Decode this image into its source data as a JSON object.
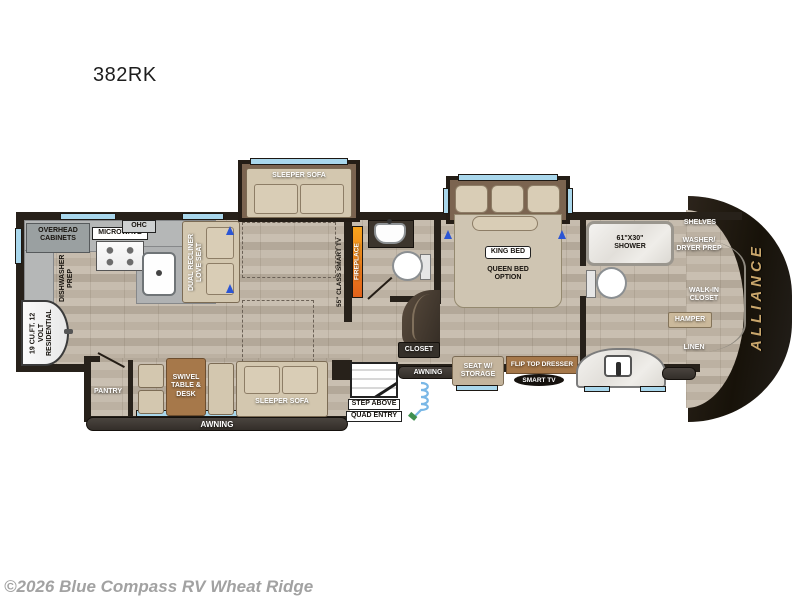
{
  "page": {
    "model": "382RK",
    "copyright": "©2026 Blue Compass RV Wheat Ridge"
  },
  "floorplan": {
    "brand": "ALLIANCE",
    "kitchen": {
      "overhead_cabinets": "OVERHEAD CABINETS",
      "microwave": "MICROWAVE",
      "ohc": "OHC",
      "dishwasher_prep": "DISHWASHER PREP",
      "refrigerator": "19 CU.FT. 12 VOLT RESIDENTIAL",
      "pantry": "PANTRY"
    },
    "living": {
      "sleeper_sofa_top": "SLEEPER SOFA",
      "dual_recliner": "DUAL RECLINER LOVE SEAT",
      "fireplace": "FIREPLACE",
      "class_tv": "55\" CLASS SMART TV",
      "swivel_table_desk": "SWIVEL TABLE & DESK",
      "sleeper_sofa_bottom": "SLEEPER SOFA"
    },
    "entry": {
      "awning_main": "AWNING",
      "awning_entry": "AWNING",
      "step_above": "STEP ABOVE",
      "quad_entry": "QUAD ENTRY",
      "closet": "CLOSET"
    },
    "bedroom": {
      "king_bed": "KING BED",
      "queen_bed_option": "QUEEN BED OPTION",
      "seat_w_storage": "SEAT W/ STORAGE",
      "flip_top_dresser": "FLIP TOP DRESSER",
      "smart_tv": "SMART TV"
    },
    "bath": {
      "shower": "61\"x30\" SHOWER",
      "shelves": "SHELVES",
      "washer_dryer_prep": "WASHER/ DRYER PREP",
      "walk_in_closet": "WALK-IN CLOSET",
      "hamper": "HAMPER",
      "linen": "LINEN"
    },
    "colors": {
      "wall_dark": "#27211a",
      "wood_floor": "#c4baab",
      "window_blue": "#a9d7ec",
      "furniture_tan": "#d3c7af",
      "table_brown": "#a6784a",
      "fireplace_orange": "#f08c1e",
      "brand_gold": "#c9a66b"
    }
  }
}
